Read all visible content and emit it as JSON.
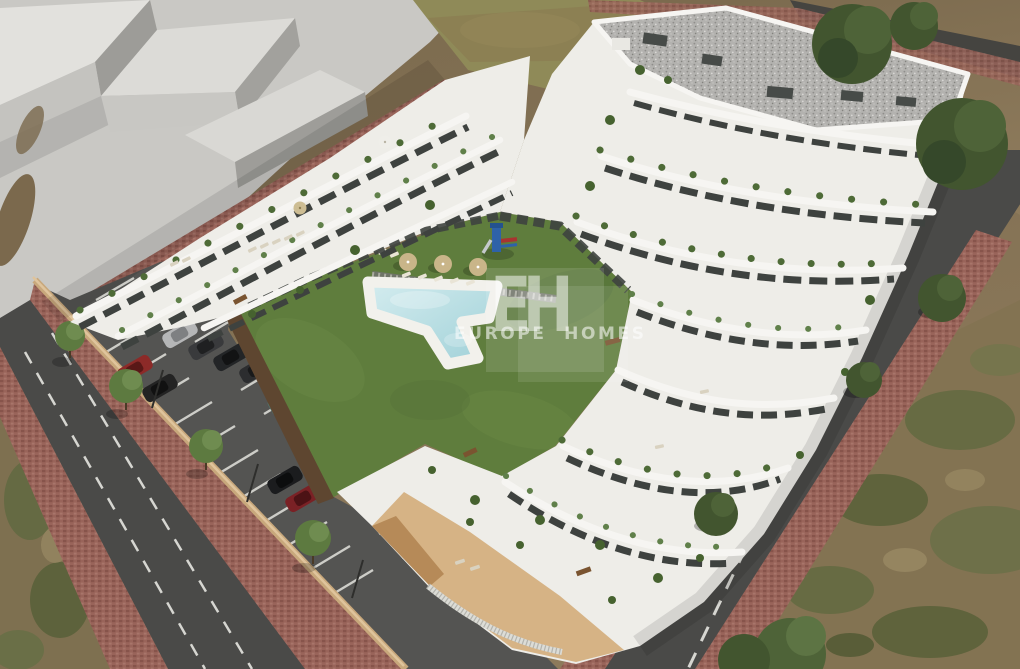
{
  "scene": {
    "description": "Aerial 3D architectural render of a white terraced apartment complex with a courtyard lawn, free-form swimming pool, sun loungers and parasols, a small playground, a striped parking lot with cars, perimeter roads with red paver sidewalks, and scrubland",
    "elements": [
      "terraced-apartment-building",
      "gravel-flat-roof",
      "courtyard-lawn",
      "swimming-pool",
      "pool-deck",
      "parasols",
      "sun-loungers",
      "playground",
      "parking-lot",
      "parked-cars",
      "street-trees",
      "lamp-posts",
      "perimeter-wall",
      "asphalt-roads",
      "paver-sidewalks",
      "concrete-plaza",
      "massing-blocks",
      "dirt-field",
      "scrubland",
      "watermark"
    ]
  },
  "watermark": {
    "monogram": "EH",
    "brand": "EUROPE HOMES"
  },
  "palette": {
    "concrete": "#c9c8c4",
    "building_white": "#eeede8",
    "parapet_white": "#f6f5f2",
    "glazing_dark": "#3e423f",
    "lawn_green": "#5f7d3d",
    "pool_water": "#b7dde2",
    "pool_deck": "#f2f1ec",
    "road_asphalt": "#4a4a48",
    "parking_asphalt": "#545452",
    "paver_red": "#99645a",
    "dirt_brown": "#83704f",
    "scrub_green": "#55663b",
    "gravel_roof": "#b3b2af",
    "tan_wall": "#c8a87c",
    "tan_base": "#d6b385",
    "tree_green": "#42552f",
    "stripe_white": "#e3e3dd",
    "watermark_white": "rgba(255,255,255,0.55)",
    "car_silver": "#b5b6b7",
    "car_gray": "#393a3c",
    "car_black": "#1e2022",
    "car_red": "#8c2a28",
    "car_dark_red": "#7a2125",
    "car_teal": "#527069"
  }
}
